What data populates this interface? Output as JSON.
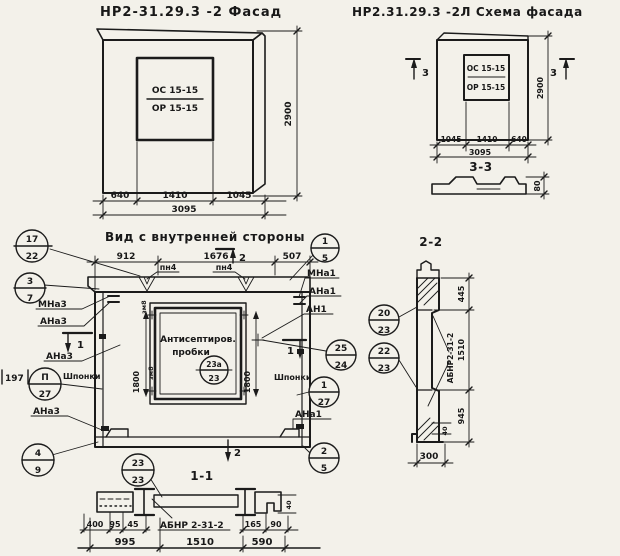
{
  "colors": {
    "paper": "#f3f1ea",
    "ink": "#1b1b1b"
  },
  "facade": {
    "title": "НР2-31.29.3 -2 Фасад",
    "win_top": "ОС 15-15",
    "win_bot": "ОР 15-15",
    "dim_h": "2900",
    "d640": "640",
    "d1410": "1410",
    "d1045": "1045",
    "total": "3095"
  },
  "scheme": {
    "title": "НР2.31.29.3 -2Л  Схема фасада",
    "win_top": "ОС 15-15",
    "win_bot": "ОР 15-15",
    "dim_h": "2900",
    "d1045": "1045",
    "d1410": "1410",
    "d640": "640",
    "total": "3095",
    "marker": "3",
    "sec_title": "3-3",
    "sec_dim": "80"
  },
  "inner": {
    "title": "Вид с внутренней стороны",
    "d912": "912",
    "d1676": "1676",
    "d507": "507",
    "pn": "пн4",
    "marker2": "2",
    "marker1": "1",
    "d1800": "1800",
    "d197": "197",
    "win_line1": "Антисептиров.",
    "win_line2": "пробки",
    "mna3": "МНа3",
    "ana3": "АНа3",
    "shponki": "Шпонки",
    "mna1": "МНа1",
    "ana1": "АНа1",
    "an1": "АН1",
    "corner_mark": "зм8"
  },
  "sec22": {
    "title": "2-2",
    "mark": "АБНР2-31-2",
    "d445": "445",
    "d1510": "1510",
    "d945": "945",
    "d300": "300",
    "d40": "40"
  },
  "sec11": {
    "title": "1-1",
    "mark": "АБНР 2-31-2",
    "d400": "400",
    "d95": "95",
    "d45": "45",
    "d165": "165",
    "d90": "90",
    "d995": "995",
    "d1510": "1510",
    "d590": "590",
    "d40": "40"
  },
  "callouts": {
    "c17_22": {
      "t": "17",
      "b": "22"
    },
    "c3_7": {
      "t": "3",
      "b": "7"
    },
    "cp_27": {
      "t": "П",
      "b": "27"
    },
    "c4_9": {
      "t": "4",
      "b": "9"
    },
    "c23_23": {
      "t": "23",
      "b": "23"
    },
    "c1_5": {
      "t": "1",
      "b": "5"
    },
    "c25_24": {
      "t": "25",
      "b": "24"
    },
    "c1_27": {
      "t": "1",
      "b": "27"
    },
    "c2_5": {
      "t": "2",
      "b": "5"
    },
    "c23a_23": {
      "t": "23а",
      "b": "23"
    },
    "c20_23": {
      "t": "20",
      "b": "23"
    },
    "c22_23": {
      "t": "22",
      "b": "23"
    }
  }
}
